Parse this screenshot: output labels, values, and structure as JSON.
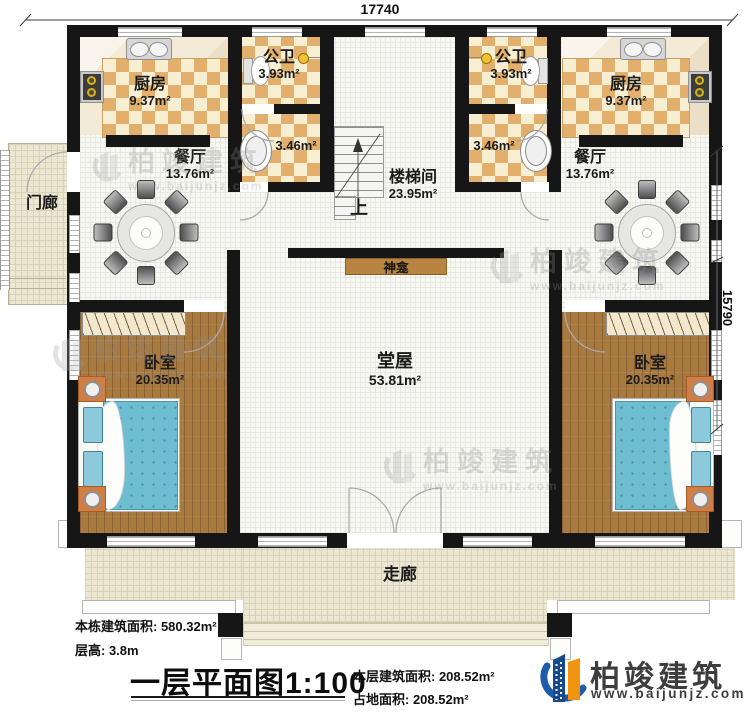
{
  "plan": {
    "dimensions": {
      "width": "17740",
      "depth": "15790"
    },
    "rooms": {
      "porch": {
        "name": "门廊"
      },
      "kitchen_left": {
        "name": "厨房",
        "area": "9.37m²"
      },
      "bath_left": {
        "name": "公卫",
        "area": "3.93m²"
      },
      "washroom_left": {
        "area": "3.46m²"
      },
      "dining_left": {
        "name": "餐厅",
        "area": "13.76m²"
      },
      "stairwell": {
        "name": "楼梯间",
        "area": "23.95m²",
        "up": "上"
      },
      "bath_right": {
        "name": "公卫",
        "area": "3.93m²"
      },
      "washroom_right": {
        "area": "3.46m²"
      },
      "kitchen_right": {
        "name": "厨房",
        "area": "9.37m²"
      },
      "dining_right": {
        "name": "餐厅",
        "area": "13.76m²"
      },
      "shrine": {
        "name": "神龛"
      },
      "hall": {
        "name": "堂屋",
        "area": "53.81m²"
      },
      "bedroom_left": {
        "name": "卧室",
        "area": "20.35m²"
      },
      "bedroom_right": {
        "name": "卧室",
        "area": "20.35m²"
      },
      "corridor": {
        "name": "走廊"
      }
    }
  },
  "footer": {
    "total_building_area": "本栋建筑面积: 580.32m²",
    "floor_height": "层高: 3.8m",
    "title": "一层平面图1:100",
    "floor_area": "本层建筑面积: 208.52m²",
    "ground_area": "占地面积: 208.52m²"
  },
  "logo": {
    "brand": "柏竣建筑",
    "website": "www.baijunjz.com"
  },
  "watermark": {
    "brand": "柏竣建筑",
    "website": "www.baijunjz.com"
  },
  "colors": {
    "wall": "#161616",
    "checker": "#e2b06c",
    "wood": "#a87a40",
    "bed": "#6fbdd1",
    "corridor": "#ebe7d2",
    "logo_blue": "#1d5cab",
    "logo_orange": "#f0930f"
  }
}
